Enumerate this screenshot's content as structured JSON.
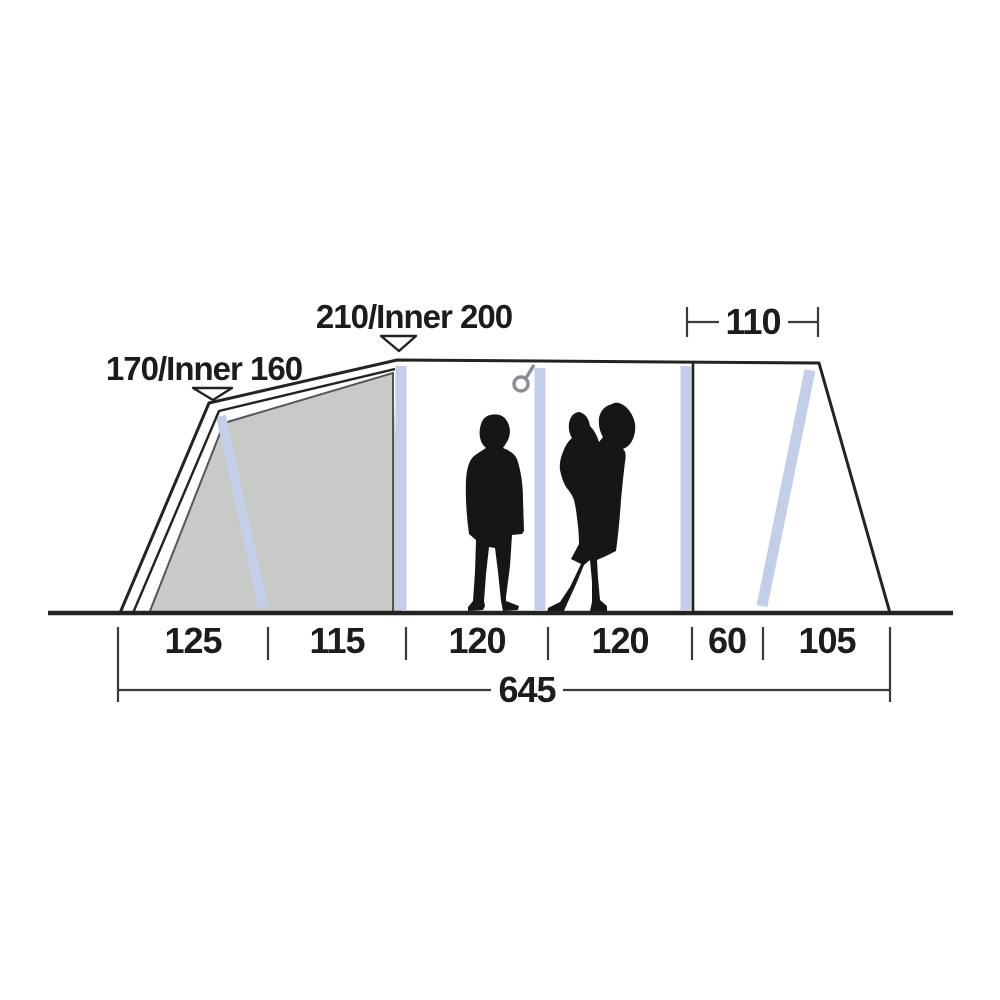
{
  "diagram": {
    "type": "tent-side-profile-dimensions",
    "labels": {
      "left_height": "170/Inner 160",
      "ridge_height": "210/Inner 200",
      "canopy_width": "110",
      "sections": [
        "125",
        "115",
        "120",
        "120",
        "60",
        "105"
      ],
      "total_length": "645"
    },
    "icons": {
      "hook": "hanging-hook",
      "height_marker": "down-triangle-arrow"
    },
    "colors": {
      "bg": "#ffffff",
      "line": "#232323",
      "dim": "#3a3a3a",
      "text": "#1c1c1c",
      "pole": "#c3cfe8",
      "inner_tent": "#c8cac7",
      "inner_edge": "#54575a",
      "hook": "#8a8e93",
      "person": "#161616"
    }
  }
}
